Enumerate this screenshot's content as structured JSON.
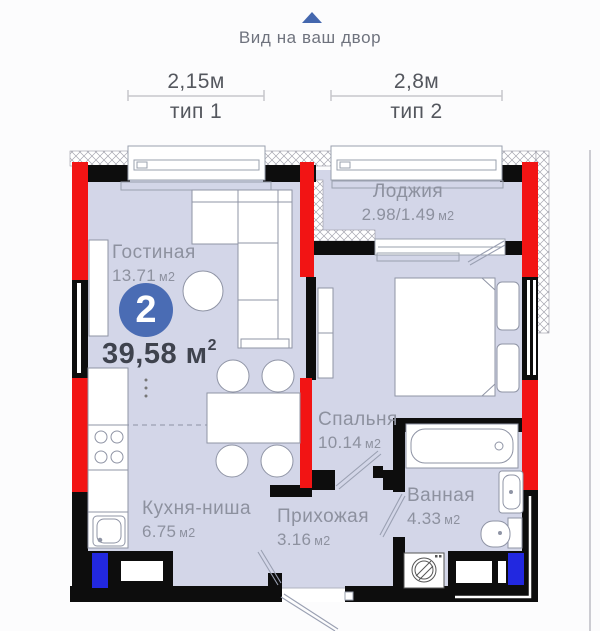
{
  "header": {
    "direction_label": "Вид на ваш двор"
  },
  "dimensions": [
    {
      "size": "2,15м",
      "type_label": "тип 1"
    },
    {
      "size": "2,8м",
      "type_label": "тип 2"
    }
  ],
  "summary": {
    "rooms_count": "2",
    "total_area": "39,58 м",
    "total_area_sup": "2"
  },
  "rooms": {
    "living": {
      "name": "Гостиная",
      "area": "13.71",
      "unit": "м2"
    },
    "loggia": {
      "name": "Лоджия",
      "area": "2.98/1.49",
      "unit": "м2"
    },
    "bedroom": {
      "name": "Спальня",
      "area": "10.14",
      "unit": "м2"
    },
    "kitchen": {
      "name": "Кухня-ниша",
      "area": "6.75",
      "unit": "м2"
    },
    "hallway": {
      "name": "Прихожая",
      "area": "3.16",
      "unit": "м2"
    },
    "bathroom": {
      "name": "Ванная",
      "area": "4.33",
      "unit": "м2"
    }
  },
  "colors": {
    "accent_red": "#f21414",
    "wall_black": "#0d0d0d",
    "vent_blue": "#2228e0",
    "badge_blue": "#4a6cb4",
    "arrow_blue": "#4467ae",
    "room_fill": "#d3d6e8"
  }
}
